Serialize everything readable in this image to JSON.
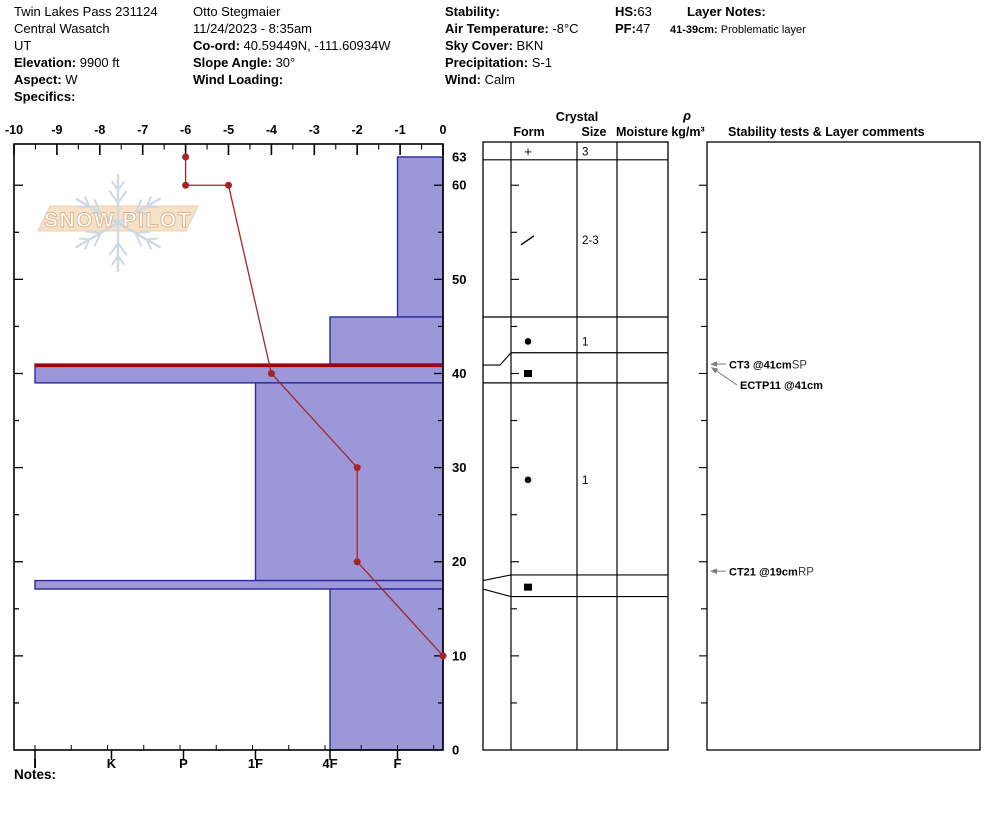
{
  "header": {
    "columns": [
      {
        "x": 14,
        "lines": [
          [
            {
              "t": "Twin Lakes Pass 231124"
            }
          ],
          [
            {
              "t": "Central Wasatch"
            }
          ],
          [
            {
              "t": "UT"
            }
          ],
          [
            {
              "t": "Elevation:",
              "b": 1
            },
            {
              "t": " 9900 ft"
            }
          ],
          [
            {
              "t": "Aspect:",
              "b": 1
            },
            {
              "t": " W"
            }
          ],
          [
            {
              "t": "Specifics:",
              "b": 1
            }
          ]
        ]
      },
      {
        "x": 193,
        "lines": [
          [
            {
              "t": "Otto Stegmaier"
            }
          ],
          [
            {
              "t": "11/24/2023 - 8:35am"
            }
          ],
          [
            {
              "t": "Co-ord:",
              "b": 1
            },
            {
              "t": " 40.59449N, -111.60934W"
            }
          ],
          [
            {
              "t": "Slope Angle:",
              "b": 1
            },
            {
              "t": " 30°"
            }
          ],
          [
            {
              "t": "Wind Loading:",
              "b": 1
            }
          ]
        ]
      },
      {
        "x": 445,
        "lines": [
          [
            {
              "t": "Stability:",
              "b": 1
            }
          ],
          [
            {
              "t": "Air Temperature:",
              "b": 1
            },
            {
              "t": " -8°C"
            }
          ],
          [
            {
              "t": "Sky Cover:",
              "b": 1
            },
            {
              "t": " BKN"
            }
          ],
          [
            {
              "t": "Precipitation:",
              "b": 1
            },
            {
              "t": " S-1"
            }
          ],
          [
            {
              "t": "Wind:",
              "b": 1
            },
            {
              "t": "  Calm"
            }
          ]
        ]
      },
      {
        "x": 615,
        "lines": [
          [
            {
              "t": "HS:",
              "b": 1
            },
            {
              "t": "63"
            }
          ],
          [
            {
              "t": "PF:",
              "b": 1
            },
            {
              "t": "47"
            }
          ]
        ]
      },
      {
        "x": 687,
        "lines": [
          [
            {
              "t": "Layer Notes:",
              "b": 1
            }
          ]
        ]
      }
    ],
    "layer_note": {
      "x": 670,
      "y": 24,
      "depth": "41-39cm:",
      "text": " Problematic layer"
    }
  },
  "watermark": {
    "text": "SNOW PILOT"
  },
  "notes_label": "Notes:",
  "chart_data": {
    "type": "snow-profile",
    "temp_axis": {
      "min": -10,
      "max": 0,
      "major_step": 1,
      "minor_step": 0.5,
      "labels": [
        "-10",
        "-9",
        "-8",
        "-7",
        "-6",
        "-5",
        "-4",
        "-3",
        "-2",
        "-1",
        "0"
      ]
    },
    "hardness_axis": {
      "categories": [
        "I",
        "K",
        "P",
        "1F",
        "4F",
        "F"
      ]
    },
    "depth_axis": {
      "surface_cm": 63,
      "labels": [
        63,
        60,
        50,
        40,
        30,
        20,
        10,
        0
      ],
      "tick_step_cm": 5
    },
    "layers": [
      {
        "top": 63,
        "bottom": 46,
        "hardness": "F"
      },
      {
        "top": 46,
        "bottom": 41,
        "hardness": "4F"
      },
      {
        "top": 41,
        "bottom": 39,
        "hardness": "I",
        "problematic": true
      },
      {
        "top": 39,
        "bottom": 18,
        "hardness": "1F"
      },
      {
        "top": 18,
        "bottom": 17.1,
        "hardness": "I"
      },
      {
        "top": 17.1,
        "bottom": 0,
        "hardness": "4F"
      }
    ],
    "temperature_profile": [
      {
        "temp_c": -6,
        "depth_cm": 63
      },
      {
        "temp_c": -6,
        "depth_cm": 60
      },
      {
        "temp_c": -5,
        "depth_cm": 60
      },
      {
        "temp_c": -4,
        "depth_cm": 40
      },
      {
        "temp_c": -2,
        "depth_cm": 30
      },
      {
        "temp_c": -2,
        "depth_cm": 20
      },
      {
        "temp_c": 0,
        "depth_cm": 10
      }
    ],
    "crystal_table": {
      "headers": {
        "crystal": "Crystal",
        "form": "Form",
        "size": "Size",
        "moisture": "Moisture",
        "rho": "ρ",
        "rho_units": "kg/m³",
        "comments": "Stability tests & Layer comments"
      },
      "row_lines_cm": [
        {
          "cm": 62.7,
          "full": true
        },
        {
          "cm": 46.0,
          "full": true
        },
        {
          "cm": 42.2,
          "full": false
        },
        {
          "cm": 39.0,
          "full": true
        },
        {
          "cm": 18.6,
          "full": false
        },
        {
          "cm": 16.3,
          "full": false
        }
      ],
      "entries": [
        {
          "form": "plus",
          "size": "3",
          "center_cm": 63.6
        },
        {
          "form": "slash",
          "size": "2-3",
          "center_cm": 54.2
        },
        {
          "form": "dot",
          "size": "1",
          "center_cm": 43.4
        },
        {
          "form": "square",
          "size": "",
          "center_cm": 40.0
        },
        {
          "form": "dot",
          "size": "1",
          "center_cm": 28.7
        },
        {
          "form": "square",
          "size": "",
          "center_cm": 17.3
        }
      ],
      "wedge_single": {
        "at_cm": 41,
        "join_cm": 42.2
      },
      "wedge_double": {
        "top_cm": 18.0,
        "join_top_cm": 18.6,
        "bottom_cm": 17.1,
        "join_bottom_cm": 16.3
      }
    },
    "tests": [
      {
        "label": "CT3 @41cm",
        "suffix": "SP",
        "depth_cm": 41,
        "kind": "h"
      },
      {
        "label": "ECTP11 @41cm",
        "suffix": "",
        "depth_cm": 41,
        "kind": "slant"
      },
      {
        "label": "CT21 @19cm",
        "suffix": "RP",
        "depth_cm": 19,
        "kind": "h"
      }
    ],
    "colors": {
      "bar_fill": "#9b97d8",
      "bar_stroke": "#2d2a9c",
      "temp_line": "#a82424",
      "problem_line": "#aa0000",
      "frame": "#000000",
      "arrow": "#7d7d7d",
      "wm_flake": "#cdd9e4",
      "wm_band_fill": "#f6e1c7",
      "wm_band_stroke": "#ecd0ad",
      "wm_text_fill": "#fffdf9",
      "wm_text_stroke": "#d8b48e"
    }
  }
}
